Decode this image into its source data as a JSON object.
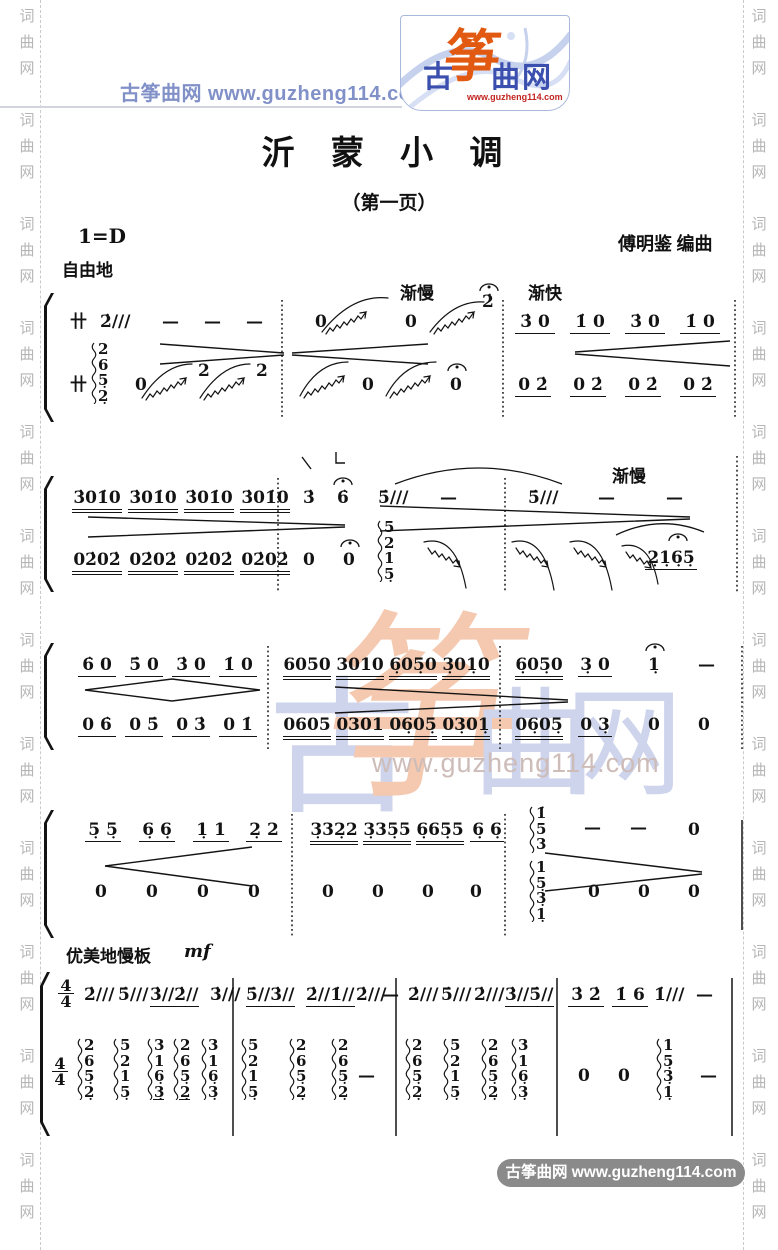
{
  "edge": {
    "column": "词\n曲\n网\n\n词\n曲\n网\n\n词\n曲\n网\n\n词\n曲\n网\n\n词\n曲\n网\n\n词\n曲\n网\n\n词\n曲\n网\n\n词\n曲\n网\n\n词\n曲\n网\n\n词\n曲\n网\n\n词\n曲\n网\n\n词\n曲\n网"
  },
  "header": {
    "site": "古筝曲网  www.guzheng114.com",
    "logo_gu": "古",
    "logo_zheng": "筝",
    "logo_quwang": "曲网",
    "logo_url": "www.guzheng114.com"
  },
  "title": "沂 蒙 小 调",
  "subtitle": "（第一页）",
  "key_signature": "1=D",
  "credit": "傅明鉴  编曲",
  "marks": {
    "ziyou": "自由地",
    "jianman": "渐慢",
    "jiankuai": "渐快",
    "jianman2": "渐慢",
    "lento": "优美地慢板",
    "mf": "mf",
    "ts_top": "4",
    "ts_bottom": "4",
    "sym": "卄"
  },
  "watermark": {
    "gu": "古",
    "zheng": "筝",
    "qu": "曲",
    "wang": "网",
    "url": "www.guzheng114.com"
  },
  "footer": {
    "site": "古筝曲网  www.guzheng114.com"
  },
  "s1": {
    "m1u": [
      "2̇///",
      "—",
      "—",
      "—"
    ],
    "m2u": [
      "0",
      "0",
      "2̇"
    ],
    "m3u": [
      "3̇ 0",
      "1̇ 0",
      "3̇ 0",
      "1̇ 0"
    ],
    "chord": "2\n6\n5̣\n2̣",
    "m1l": [
      "0",
      "2",
      "2"
    ],
    "m2l": [
      "0",
      "0"
    ],
    "m3l": [
      "0 2̇",
      "0 2̇",
      "0 2̇",
      "0 2̇"
    ]
  },
  "s2": {
    "m1u": [
      "3̇01̇0",
      "3̇01̇0",
      "3̇01̇0",
      "3̇01̇0"
    ],
    "m2u": [
      "3̇",
      "6̇",
      "5̇///",
      "—"
    ],
    "m3u": [
      "5̇///",
      "—",
      "—"
    ],
    "m1l": [
      "02̇02̇",
      "02̇02̇",
      "02̇02̇",
      "02̇02̇"
    ],
    "m2l": [
      "0",
      "0"
    ],
    "chord": "5\n2\n1\n5̣",
    "m3l": "2̣1̣6̣5̣"
  },
  "s3": {
    "m1u": [
      "6̇ 0",
      "5̇ 0",
      "3̇ 0",
      "1̇ 0"
    ],
    "m2u": [
      "6050",
      "3010",
      "6̣05̣0",
      "3̣01̣0"
    ],
    "m3u": [
      "6̣05̣0",
      "3̣ 0",
      "1̣",
      "—"
    ],
    "m1l": [
      "0 6̇",
      "0 5̇",
      "0 3̇",
      "0 1̇"
    ],
    "m2l": [
      "0605",
      "0301",
      "06̣05̣",
      "03̣01̣"
    ],
    "m3l": [
      "06̣05̣",
      "0 3̣",
      "0",
      "0"
    ]
  },
  "s4": {
    "m1u": [
      "5̣ 5̣",
      "6̣ 6̣",
      "1̣ 1",
      "2̣ 2"
    ],
    "m2u": [
      "3̣32̣2",
      "3̣35̣5",
      "6̣65̣5",
      "6̣ 6̣"
    ],
    "chord_u": "1̇\n5\n3",
    "m3u": [
      "—",
      "—",
      "0"
    ],
    "m1l": [
      "0",
      "0",
      "0",
      "0"
    ],
    "m2l": [
      "0",
      "0",
      "0",
      "0"
    ],
    "chord_l": "1\n5̣\n3̣\n1̣",
    "m3l": [
      "0",
      "0",
      "0"
    ]
  },
  "s5": {
    "m1u": [
      "2̇///",
      "5̇///",
      "3̇//2̇//",
      "3̇///"
    ],
    "m2u": [
      "5̇//3̇//",
      "2̇//1̇//",
      "2̇///",
      "—"
    ],
    "m3u": [
      "2̇///",
      "5̇///",
      "2̇///",
      "3̇//5̇//"
    ],
    "m4u": [
      "3̇ 2̇",
      "1̇ 6",
      "1̇///",
      "—"
    ],
    "l1": [
      "2\n6\n5̣\n2̣",
      "5\n2\n1\n5̣",
      "3\n1\n6̣\n3̣",
      "2\n6\n5̣\n2̣",
      "3\n1\n6̣\n3̣"
    ],
    "l2": [
      "5\n2\n1\n5̣",
      "2\n6\n5̣\n2̣",
      "2\n6\n5̣\n2̣"
    ],
    "l2d": "—",
    "l3": [
      "2\n6\n5̣\n2̣",
      "5\n2\n1\n5̣",
      "2\n6\n5̣\n2̣",
      "3\n1\n6̣\n3̣"
    ],
    "l4": [
      "0",
      "0"
    ],
    "chord_l4": "1\n5̣\n3̣\n1̣",
    "l4d": "—"
  }
}
